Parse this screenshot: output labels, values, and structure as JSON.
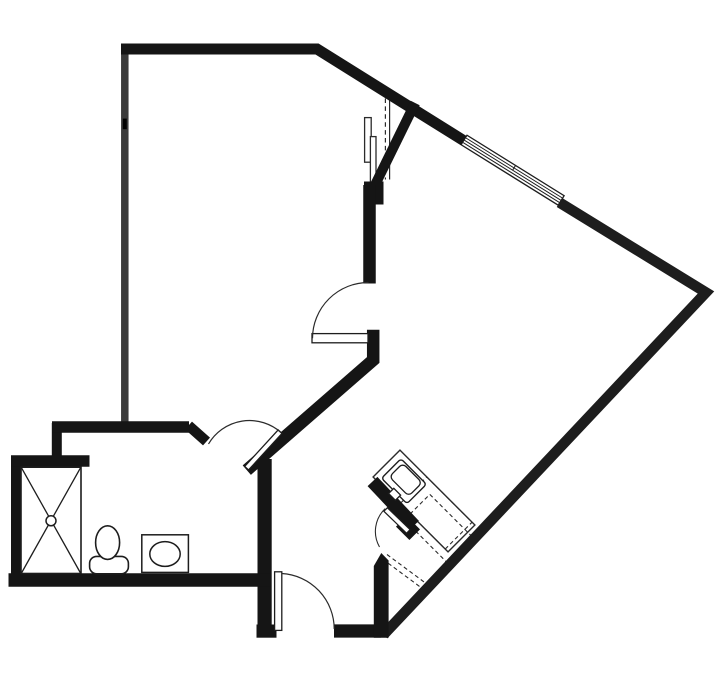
{
  "app": {
    "title": "Apartment Floor Plan Drawing"
  },
  "canvas": {
    "width": 720,
    "height": 690,
    "background": "#ffffff"
  },
  "colors": {
    "wall_black": "#151515",
    "wall_left_gray": "#3a3a3a",
    "wall_right_gray": "#252525",
    "thin_line": "#2b2b2b",
    "white": "#ffffff"
  },
  "floor_plan": {
    "description": "Single-unit floor plan: large angled living room right, bedroom upper-left, bathroom lower-left with shower/toilet/sink, kitchenette along lower-right diagonal wall, entry door bottom center",
    "elements": [
      {
        "kind": "rect",
        "name": "kitchen-counter",
        "x": 371,
        "y": 482,
        "w": 106,
        "h": 38,
        "transform": "rotate(45 424 501)",
        "fill": "#ffffff",
        "stroke": "#2b2b2b",
        "width": 1.4
      },
      {
        "kind": "rect",
        "name": "dishwasher-dashed-outline",
        "x": 404,
        "y": 494,
        "w": 64,
        "h": 38,
        "transform": "rotate(45 436 513)",
        "fill": "none",
        "stroke": "#2b2b2b",
        "width": 1.1,
        "dash": "4 3"
      },
      {
        "kind": "rect",
        "name": "base-cabinet-dashed-outline",
        "x": 408,
        "y": 511,
        "w": 62,
        "h": 36,
        "transform": "rotate(45 439 529)",
        "fill": "none",
        "stroke": "#2b2b2b",
        "width": 1.1,
        "dash": "4 3"
      },
      {
        "kind": "line",
        "name": "cabinet-dashed-line-a",
        "x1": 387,
        "y1": 554.5,
        "x2": 427.5,
        "y2": 584.5,
        "stroke": "#2b2b2b",
        "width": 1.1,
        "dash": "4 3"
      },
      {
        "kind": "line",
        "name": "cabinet-dashed-line-b",
        "x1": 382.5,
        "y1": 559,
        "x2": 423,
        "y2": 589,
        "stroke": "#2b2b2b",
        "width": 1.1,
        "dash": "4 3"
      },
      {
        "kind": "rect",
        "name": "window-frame",
        "x": 455.4,
        "y": 164.6,
        "w": 114.4,
        "h": 11.2,
        "transform": "rotate(31.9 512.6 170.2)",
        "fill": "#ffffff",
        "stroke": "#1d1d1d",
        "width": 1.3
      },
      {
        "kind": "line",
        "name": "window-glazing-line-1",
        "x1": 456,
        "y1": 167.5,
        "x2": 569.3,
        "y2": 167.5,
        "transform": "rotate(31.9 512.6 170.2)",
        "stroke": "#1d1d1d",
        "width": 1
      },
      {
        "kind": "line",
        "name": "window-glazing-line-2",
        "x1": 456,
        "y1": 170.2,
        "x2": 569.3,
        "y2": 170.2,
        "transform": "rotate(31.9 512.6 170.2)",
        "stroke": "#1d1d1d",
        "width": 1
      },
      {
        "kind": "line",
        "name": "window-glazing-line-3",
        "x1": 456,
        "y1": 172.9,
        "x2": 569.3,
        "y2": 172.9,
        "transform": "rotate(31.9 512.6 170.2)",
        "stroke": "#1d1d1d",
        "width": 1
      },
      {
        "kind": "line",
        "name": "window-center-tick",
        "x1": 512.6,
        "y1": 164.6,
        "x2": 512.6,
        "y2": 170.4,
        "transform": "rotate(31.9 512.6 170.2)",
        "stroke": "#1d1d1d",
        "width": 1
      },
      {
        "kind": "rect",
        "name": "closet-slider-panel-1",
        "x": 364.6,
        "y": 117.6,
        "w": 6.6,
        "h": 44.6,
        "fill": "#ffffff",
        "stroke": "#2b2b2b",
        "width": 1.3
      },
      {
        "kind": "rect",
        "name": "closet-slider-panel-2",
        "x": 370.4,
        "y": 136.6,
        "w": 5.6,
        "h": 46.2,
        "fill": "#ffffff",
        "stroke": "#2b2b2b",
        "width": 1.3
      },
      {
        "kind": "line",
        "name": "closet-shelf-dashed-line",
        "x1": 385.4,
        "y1": 98.5,
        "x2": 385.4,
        "y2": 179.5,
        "stroke": "#2b2b2b",
        "width": 1.2,
        "dash": "4.5 3.4"
      },
      {
        "kind": "line",
        "name": "closet-shelf-edge-line",
        "x1": 389.6,
        "y1": 98.5,
        "x2": 389.6,
        "y2": 179.5,
        "stroke": "#2b2b2b",
        "width": 1.2
      },
      {
        "kind": "path",
        "name": "wall-left",
        "d": "M124.8,44 V424.5",
        "stroke": "#3a3a3a",
        "width": 7.5
      },
      {
        "kind": "rect",
        "name": "wall-left-tick",
        "x": 122.8,
        "y": 118.6,
        "w": 4,
        "h": 10.6,
        "fill": "#000000"
      },
      {
        "kind": "path",
        "name": "wall-top-and-upper-diagonal",
        "d": "M121,49 H317 L463.5,140.5",
        "stroke": "#151515",
        "width": 11,
        "join": "miter"
      },
      {
        "kind": "path",
        "name": "wall-right-diagonals",
        "d": "M559.5,202.5 L706,292.5 L383.5,634.8",
        "stroke": "#1d1d1d",
        "width": 10.5,
        "join": "miter"
      },
      {
        "kind": "path",
        "name": "wall-closet-branch",
        "d": "M413,107.5 L375.5,184",
        "stroke": "#151515",
        "width": 10,
        "cap": "square"
      },
      {
        "kind": "rect",
        "name": "wall-closet-post",
        "x": 364,
        "y": 181.5,
        "w": 19.5,
        "h": 23,
        "fill": "#151515"
      },
      {
        "kind": "path",
        "name": "wall-center-vertical",
        "d": "M369.5,185 V283.5",
        "stroke": "#151515",
        "width": 12.5
      },
      {
        "kind": "path",
        "name": "wall-interior-diagonal",
        "d": "M373.2,336 L373.2,360 L251.5,466",
        "stroke": "#151515",
        "width": 12.5,
        "join": "miter",
        "cap": "square"
      },
      {
        "kind": "path",
        "name": "wall-bathroom-right",
        "d": "M264.6,459 V637.2",
        "stroke": "#151515",
        "width": 14.2
      },
      {
        "kind": "path",
        "name": "wall-bathroom-bottom",
        "d": "M8.5,580 H271",
        "stroke": "#151515",
        "width": 13.5
      },
      {
        "kind": "path",
        "name": "wall-bathroom-left",
        "d": "M16,456 V580",
        "stroke": "#151515",
        "width": 10
      },
      {
        "kind": "path",
        "name": "wall-shower-top",
        "d": "M11,461 H89.5",
        "stroke": "#151515",
        "width": 11.5
      },
      {
        "kind": "path",
        "name": "wall-bathroom-jog",
        "d": "M56.8,423 V459",
        "stroke": "#151515",
        "width": 10
      },
      {
        "kind": "path",
        "name": "wall-bathroom-top",
        "d": "M52,427 H189",
        "stroke": "#151515",
        "width": 11.5
      },
      {
        "kind": "path",
        "name": "wall-bathroom-door-stub",
        "d": "M188.5,425.5 L206.5,441.5",
        "stroke": "#151515",
        "width": 10.5
      },
      {
        "kind": "rect",
        "name": "wall-entry-left-foot",
        "x": 256.5,
        "y": 624.5,
        "w": 20,
        "h": 13.2,
        "fill": "#151515"
      },
      {
        "kind": "path",
        "name": "wall-entry-bottom",
        "d": "M334,631 H381",
        "stroke": "#151515",
        "width": 13.2
      },
      {
        "kind": "path",
        "name": "wall-entry-cap",
        "d": "M373.8,637.8 L373.8,566 L381.3,553 L388.6,560.5 L388.6,637.8 Z",
        "fill": "#151515"
      },
      {
        "kind": "path",
        "name": "wall-kitchen-partition",
        "d": "M372.5,481.5 L414,525.5",
        "stroke": "#151515",
        "width": 13.5
      },
      {
        "kind": "rect",
        "name": "wall-kitchen-partition-foot",
        "x": 398.5,
        "y": 520.5,
        "w": 19,
        "h": 15,
        "transform": "rotate(45 408 528)",
        "fill": "#151515"
      },
      {
        "kind": "rect",
        "name": "kitchen-sink-outer",
        "x": 386,
        "y": 467.5,
        "w": 36,
        "h": 27.5,
        "rx": 3,
        "transform": "rotate(45 404 481.2)",
        "fill": "#ffffff",
        "stroke": "#1d1d1d",
        "width": 1.4
      },
      {
        "kind": "rect",
        "name": "kitchen-sink-basin",
        "x": 391.4,
        "y": 470.3,
        "w": 27.4,
        "h": 19,
        "rx": 4.5,
        "transform": "rotate(45 405.5 480.5)",
        "fill": "#ffffff",
        "stroke": "#1d1d1d",
        "width": 1.3
      },
      {
        "kind": "rect",
        "name": "kitchen-sink-faucet",
        "x": 389.8,
        "y": 490.6,
        "w": 9.6,
        "h": 7.4,
        "transform": "rotate(45 394.6 494.3)",
        "fill": "#ffffff",
        "stroke": "#1d1d1d",
        "width": 1.3
      },
      {
        "kind": "rect",
        "name": "bathroom-door-leaf",
        "x": 238.6,
        "y": 447.4,
        "w": 49.5,
        "h": 5.2,
        "transform": "rotate(-47.5 263.3 450)",
        "fill": "#ffffff",
        "stroke": "#1d1d1d",
        "width": 1.3
      },
      {
        "kind": "path",
        "name": "bathroom-door-swing-arc",
        "d": "M208.5,444 A47.5,47.5 0 0 1 281,432.5",
        "fill": "none",
        "stroke": "#2b2b2b",
        "width": 1.2
      },
      {
        "kind": "rect",
        "name": "center-door-leaf",
        "x": 312,
        "y": 333.6,
        "w": 56,
        "h": 9.2,
        "fill": "#ffffff",
        "stroke": "#1d1d1d",
        "width": 1.3
      },
      {
        "kind": "path",
        "name": "center-door-swing-arc",
        "d": "M312.5,338.2 A56,56 0 0 1 368.6,282.5",
        "fill": "none",
        "stroke": "#2b2b2b",
        "width": 1.2
      },
      {
        "kind": "rect",
        "name": "entry-door-leaf",
        "x": 274.6,
        "y": 571.8,
        "w": 7.2,
        "h": 58.6,
        "fill": "#ffffff",
        "stroke": "#1d1d1d",
        "width": 1.3
      },
      {
        "kind": "path",
        "name": "entry-door-swing-arc",
        "d": "M281.8,573.5 A55.6,55.6 0 0 1 334.2,629",
        "fill": "none",
        "stroke": "#2b2b2b",
        "width": 1.2
      },
      {
        "kind": "rect",
        "name": "kitchen-closet-door-leaf",
        "x": 381.2,
        "y": 518,
        "w": 31.5,
        "h": 5,
        "transform": "rotate(44 397 520.5)",
        "fill": "#ffffff",
        "stroke": "#1d1d1d",
        "width": 1.2
      },
      {
        "kind": "path",
        "name": "kitchen-closet-door-swing-arc",
        "d": "M385.2,508.6 A31.5,31.5 0 0 0 379.5,547",
        "fill": "none",
        "stroke": "#2b2b2b",
        "width": 1.1
      },
      {
        "kind": "rect",
        "name": "shower-pan",
        "x": 21,
        "y": 467.2,
        "w": 60,
        "h": 106.3,
        "fill": "#ffffff",
        "stroke": "#1d1d1d",
        "width": 1.6
      },
      {
        "kind": "line",
        "name": "shower-cross-line-1",
        "x1": 21.5,
        "y1": 467.8,
        "x2": 80.5,
        "y2": 573,
        "stroke": "#1d1d1d",
        "width": 1.3
      },
      {
        "kind": "line",
        "name": "shower-cross-line-2",
        "x1": 80.5,
        "y1": 467.8,
        "x2": 21.5,
        "y2": 573,
        "stroke": "#1d1d1d",
        "width": 1.3
      },
      {
        "kind": "circle",
        "name": "shower-drain",
        "cx": 51,
        "cy": 520.8,
        "r": 5,
        "fill": "#ffffff",
        "stroke": "#1d1d1d",
        "width": 1.5
      },
      {
        "kind": "rect",
        "name": "toilet-tank",
        "x": 89.6,
        "y": 556.4,
        "w": 38.8,
        "h": 17.4,
        "rx": 7,
        "fill": "#ffffff",
        "stroke": "#1d1d1d",
        "width": 1.6
      },
      {
        "kind": "ellipse",
        "name": "toilet-bowl",
        "cx": 107.6,
        "cy": 542.6,
        "rx": 12,
        "ry": 16.8,
        "fill": "#ffffff",
        "stroke": "#1d1d1d",
        "width": 1.6
      },
      {
        "kind": "rect",
        "name": "bathroom-sink-counter",
        "x": 141.8,
        "y": 534.8,
        "w": 46.6,
        "h": 37.6,
        "fill": "#ffffff",
        "stroke": "#1d1d1d",
        "width": 1.5
      },
      {
        "kind": "ellipse",
        "name": "bathroom-sink-basin",
        "cx": 165,
        "cy": 554,
        "rx": 15.2,
        "ry": 12.4,
        "fill": "#ffffff",
        "stroke": "#1d1d1d",
        "width": 1.5
      }
    ]
  }
}
